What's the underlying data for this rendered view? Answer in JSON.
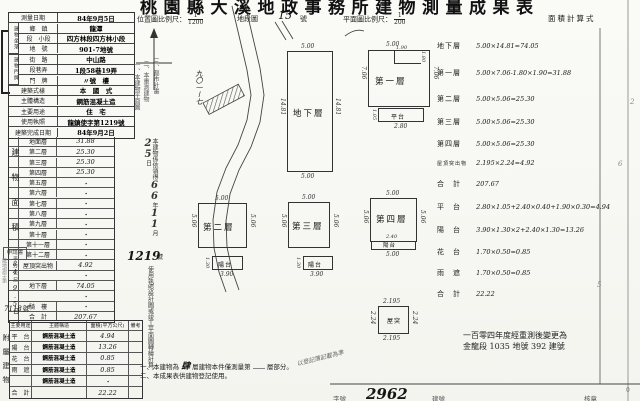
{
  "title": "桃園縣大溪地政事務所建物測量成果表",
  "header": {
    "loc_scale_label": "位置圖比例尺：",
    "loc_scale_num": "1",
    "loc_scale_den": "1200",
    "sheet_label": "地段圖",
    "sheet_no": "15",
    "sheet_unit": "號",
    "plan_scale_label": "平面圖比例尺：",
    "plan_scale_num": "1",
    "plan_scale_den": "200",
    "calc_title": "面積計算式"
  },
  "info": {
    "group1": "建物坐落",
    "group2": "建物門牌",
    "rows": [
      {
        "label": "測量日期",
        "value": "84年9月5日"
      },
      {
        "label": "鄉　鎮",
        "value": "龍潭"
      },
      {
        "label": "段　小段",
        "value": "四方林段四方林小段"
      },
      {
        "label": "地　號",
        "value": "901-7地號"
      },
      {
        "label": "街　路",
        "value": "中山路"
      },
      {
        "label": "段巷弄",
        "value": "1段58巷19弄"
      },
      {
        "label": "門　牌",
        "value": "〃號　樓"
      },
      {
        "label": "建築式樣",
        "value": "本　國　式"
      },
      {
        "label": "主體構造",
        "value": "鋼筋混凝土造"
      },
      {
        "label": "主要用途",
        "value": "住　宅"
      },
      {
        "label": "使用執照",
        "value": "龍鎮使字第1219號"
      },
      {
        "label": "建築完成日期",
        "value": "84年9月2日"
      }
    ]
  },
  "floor": {
    "side_label": "建物面積",
    "side_sub": "平方公尺",
    "rows": [
      {
        "label": "地面層",
        "value": "31.88"
      },
      {
        "label": "第二層",
        "value": "25.30"
      },
      {
        "label": "第三層",
        "value": "25.30"
      },
      {
        "label": "第四層",
        "value": "25.30"
      },
      {
        "label": "第五層",
        "value": "・"
      },
      {
        "label": "第六層",
        "value": "・"
      },
      {
        "label": "第七層",
        "value": "・"
      },
      {
        "label": "第八層",
        "value": "・"
      },
      {
        "label": "第九層",
        "value": "・"
      },
      {
        "label": "第十層",
        "value": "・"
      },
      {
        "label": "第十一層",
        "value": "・"
      },
      {
        "label": "第十二層",
        "value": "・"
      },
      {
        "label": "屋頂突出物",
        "value": "4.92"
      },
      {
        "label": "",
        "value": "・"
      },
      {
        "label": "地下層",
        "value": "74.05"
      },
      {
        "label": "",
        "value": "・"
      },
      {
        "label": "騎　樓",
        "value": "・"
      },
      {
        "label": "合　計",
        "value": "207.67"
      }
    ]
  },
  "annex": {
    "side_label": "附屬建物",
    "headers": [
      "主要用途",
      "主體構造",
      "面積(平方公尺)",
      "備考"
    ],
    "rows": [
      {
        "use": "平　台",
        "structure": "鋼筋混凝土造",
        "area": "4.94",
        "note": ""
      },
      {
        "use": "陽　台",
        "structure": "鋼筋混凝土造",
        "area": "13.26",
        "note": ""
      },
      {
        "use": "花　台",
        "structure": "鋼筋混凝土造",
        "area": "0.85",
        "note": ""
      },
      {
        "use": "雨　遮",
        "structure": "鋼筋混凝土造",
        "area": "0.85",
        "note": ""
      },
      {
        "use": "",
        "structure": "鋼筋混凝土造",
        "area": "・",
        "note": ""
      },
      {
        "use": "合　計",
        "structure": "",
        "area": "22.22",
        "note": ""
      }
    ]
  },
  "stamp": {
    "label": "申請書",
    "prefix": "龍地測字第",
    "date": "84.9.5日",
    "number": "7118號"
  },
  "mid_notes": {
    "col1": "一、本建物平面圖",
    "col2": "二、本重測建物",
    "col3": "三、都市計畫",
    "license_pre": "本建物係依領得",
    "yy": "66",
    "yy_unit": "年",
    "mm": "11",
    "mm_unit": "月",
    "dd": "25",
    "dd_unit": "日",
    "license_no": "1219",
    "license_no_unit": "號",
    "license_post": "使用執照設計圖或竣工平面圖轉繪計算。"
  },
  "map": {
    "parcel_label": "九〇一ー七"
  },
  "plans": {
    "basement": {
      "label": "地下層",
      "top": "5.00",
      "bottom": "5.00",
      "left": "14.81",
      "right": "14.81"
    },
    "f1": {
      "label": "第一層",
      "top": "5.00",
      "left": "7.06",
      "right": "7.06",
      "notch_w": "1.90",
      "notch_h": "1.80",
      "platform": "平台",
      "platform_w": "2.80",
      "platform_h": "1.05"
    },
    "f2": {
      "label": "第二層",
      "top": "5.00",
      "left": "5.06",
      "right": "5.06",
      "balcony": "陽台",
      "balcony_w": "3.90",
      "balcony_h": "1.30"
    },
    "f3": {
      "label": "第三層",
      "top": "5.00",
      "left": "5.06",
      "right": "5.06",
      "balcony": "陽台",
      "balcony_w": "3.90",
      "balcony_h": "1.30"
    },
    "f4": {
      "label": "第四層",
      "top": "5.00",
      "left": "5.06",
      "right": "5.06",
      "balcony": "陽台",
      "balcony_w": "2.40",
      "bottom": "5.00"
    },
    "roof": {
      "label": "屋突",
      "top": "2.195",
      "bottom": "2.195",
      "left": "2.24",
      "right": "2.24"
    }
  },
  "calc": {
    "lines": [
      {
        "label": "地下層",
        "formula": "5.00×14.81=74.05"
      },
      {
        "label": "第一層",
        "formula": "5.00×7.06-1.80×1.90=31.88"
      },
      {
        "label": "第二層",
        "formula": "5.00×5.06=25.30"
      },
      {
        "label": "第三層",
        "formula": "5.00×5.06=25.30"
      },
      {
        "label": "第四層",
        "formula": "5.00×5.06=25.30"
      },
      {
        "label": "屋頂突出物",
        "formula": "2.195×2.24=4.92"
      },
      {
        "label": "合　計",
        "formula": "207.67"
      },
      {
        "label": "平　台",
        "formula": "2.80×1.05+2.40×0.40+1.90×0.30=4.94"
      },
      {
        "label": "陽　台",
        "formula": "3.90×1.30×2+2.40×1.30=13.26"
      },
      {
        "label": "花　台",
        "formula": "1.70×0.50=0.85"
      },
      {
        "label": "雨　遮",
        "formula": "1.70×0.50=0.85"
      },
      {
        "label": "合　計",
        "formula": "22.22"
      }
    ],
    "resurvey_line1": "一百零四年度經重測後變更為",
    "resurvey_line2": "金龍段 1035 地號 392 建號",
    "margin_marks": [
      "2",
      "6",
      "5"
    ]
  },
  "footer": {
    "note1_pre": "一、本建物為",
    "note1_fill": "肆",
    "note1_mid": "層建物本件僅測量第",
    "note1_post": "層部分。",
    "note2": "二、本成果表供建物登記使用。",
    "scribble": "以登記簿記載為準",
    "field1": "字號",
    "hw_no": "2962",
    "field2": "建號",
    "field3": "核章",
    "tiny_mark": "0"
  }
}
